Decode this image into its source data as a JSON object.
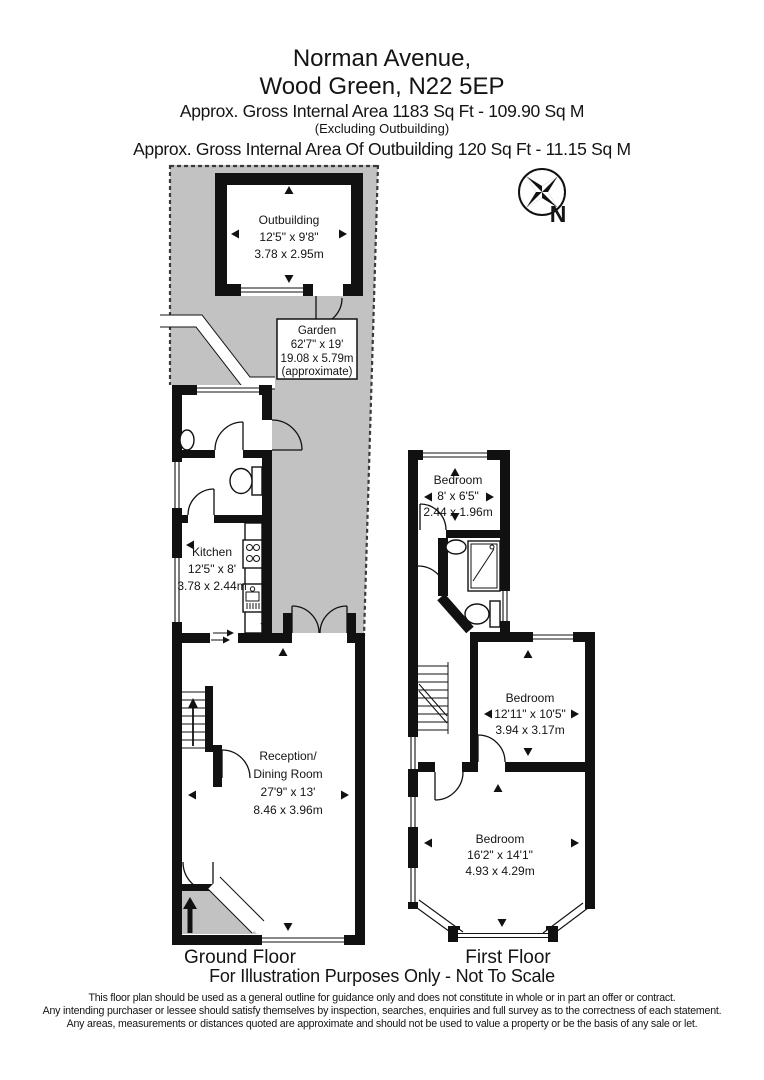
{
  "header": {
    "address_line1": "Norman Avenue,",
    "address_line2": "Wood Green, N22 5EP",
    "area_line": "Approx. Gross Internal Area  1183 Sq Ft  -  109.90 Sq M",
    "area_note": "(Excluding Outbuilding)",
    "outbuilding_area_line": "Approx. Gross Internal Area Of Outbuilding  120 Sq Ft  -  11.15 Sq M"
  },
  "compass": {
    "label": "N"
  },
  "rooms": {
    "outbuilding": {
      "name": "Outbuilding",
      "imperial": "12'5\" x 9'8\"",
      "metric": "3.78 x 2.95m"
    },
    "garden": {
      "name": "Garden",
      "imperial": "62'7\" x 19'",
      "metric": "19.08 x 5.79m",
      "note": "(approximate)"
    },
    "kitchen": {
      "name": "Kitchen",
      "imperial": "12'5\" x 8'",
      "metric": "3.78 x 2.44m"
    },
    "reception": {
      "name_line1": "Reception/",
      "name_line2": "Dining Room",
      "imperial": "27'9\" x 13'",
      "metric": "8.46 x 3.96m"
    },
    "bedroom_small": {
      "name": "Bedroom",
      "imperial": "8' x 6'5\"",
      "metric": "2.44 x 1.96m"
    },
    "bedroom_middle": {
      "name": "Bedroom",
      "imperial": "12'11\" x 10'5\"",
      "metric": "3.94 x 3.17m"
    },
    "bedroom_large": {
      "name": "Bedroom",
      "imperial": "16'2\" x 14'1\"",
      "metric": "4.93 x 4.29m"
    }
  },
  "floor_labels": {
    "ground": "Ground Floor",
    "first": "First Floor"
  },
  "footer": {
    "illustration_note": "For Illustration Purposes Only - Not To Scale",
    "disclaimer_line1": "This floor plan should be used as a general outline for guidance only and does not constitute in whole or in part an offer or contract.",
    "disclaimer_line2": "Any intending purchaser or lessee should satisfy themselves by inspection, searches, enquiries and full survey as to the correctness of each statement.",
    "disclaimer_line3": "Any areas, measurements or distances quoted are approximate and should not be used to value a property or be the basis of any sale or let."
  },
  "icons": {
    "compass": "compass-rose-north",
    "toilet": "toilet",
    "shower": "shower-tray",
    "sink": "sink-basin",
    "hob": "cooker-hob",
    "stairs": "staircase",
    "entrance": "entrance-arrow"
  },
  "colors": {
    "garden_fill": "#c2c2c2",
    "wall": "#111111",
    "background": "#ffffff",
    "text": "#1a1a1a"
  }
}
